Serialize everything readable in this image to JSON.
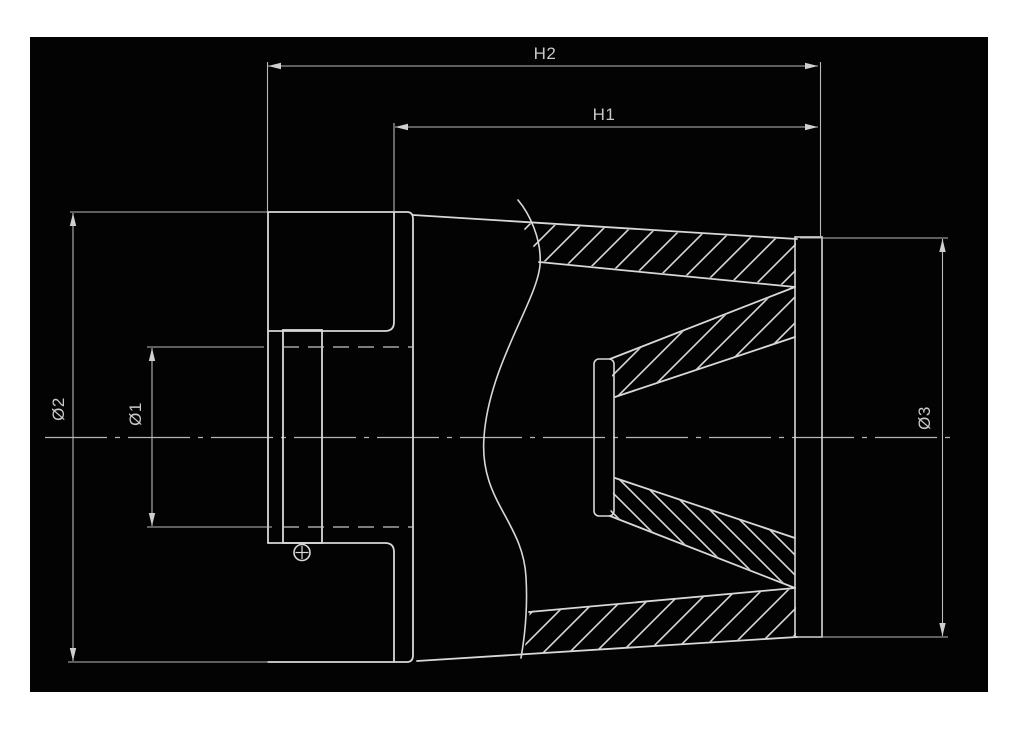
{
  "drawing": {
    "type": "technical-cross-section",
    "subject": "conical air filter side section view",
    "dimensions": {
      "h2": {
        "label": "H2"
      },
      "h1": {
        "label": "H1"
      },
      "d1": {
        "label": "Ø1"
      },
      "d2": {
        "label": "Ø2"
      },
      "d3": {
        "label": "Ø3"
      }
    },
    "colors": {
      "page": "#ffffff",
      "canvas": "#030303",
      "part_line": "#d8d8d8",
      "dimension_line": "#b9b9b9",
      "label_text": "#c9c9c9"
    }
  }
}
